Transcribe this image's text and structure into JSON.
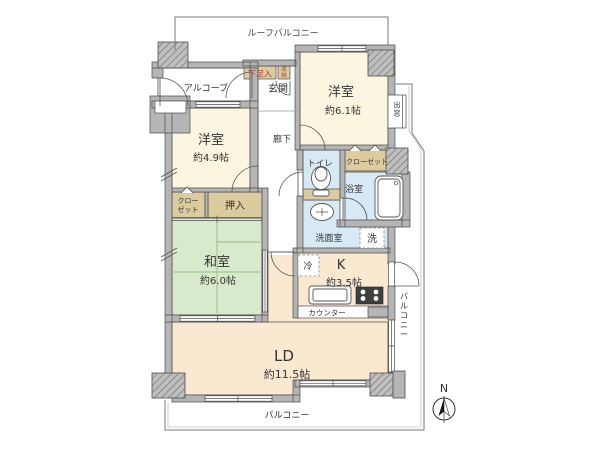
{
  "floorplan": {
    "outdoor": {
      "roof_balcony": "ルーフバルコニー",
      "balcony_side": "バルコニー",
      "balcony_bottom": "バルコニー",
      "bay_window": "出窓",
      "compass_north": "N"
    },
    "entry": {
      "alcove": "アルコーブ",
      "entrance": "玄関",
      "shoe_cabinet": "下足入",
      "storage": "収納",
      "corridor": "廊下"
    },
    "rooms": {
      "bedroom1": {
        "name": "洋室",
        "size": "約6.1帖"
      },
      "bedroom2": {
        "name": "洋室",
        "size": "約4.9帖"
      },
      "japanese_room": {
        "name": "和室",
        "size": "約6.0帖"
      },
      "kitchen": {
        "name": "K",
        "size": "約3.5帖"
      },
      "living_dining": {
        "name": "LD",
        "size": "約11.5帖"
      }
    },
    "water": {
      "toilet": "トイレ",
      "bath": "浴室",
      "washroom": "洗面室",
      "laundry": "洗",
      "refrigerator": "冷"
    },
    "storage_spaces": {
      "closet_bath_side": "クローゼット",
      "closet_west_line1": "クロー",
      "closet_west_line2": "ゼット",
      "oshiire": "押入"
    },
    "kitchen_parts": {
      "counter": "カウンター"
    },
    "colors": {
      "wall": "#B5B5B5",
      "outline": "#4D4D4D",
      "western_room": "#FCF6E0",
      "ld_kitchen": "#FAE8D1",
      "tatami": "#D9E9CB",
      "water_blue": "#D6E9F4",
      "closet_tan": "#DCCB9F",
      "label_red": "#A33B2E"
    }
  }
}
